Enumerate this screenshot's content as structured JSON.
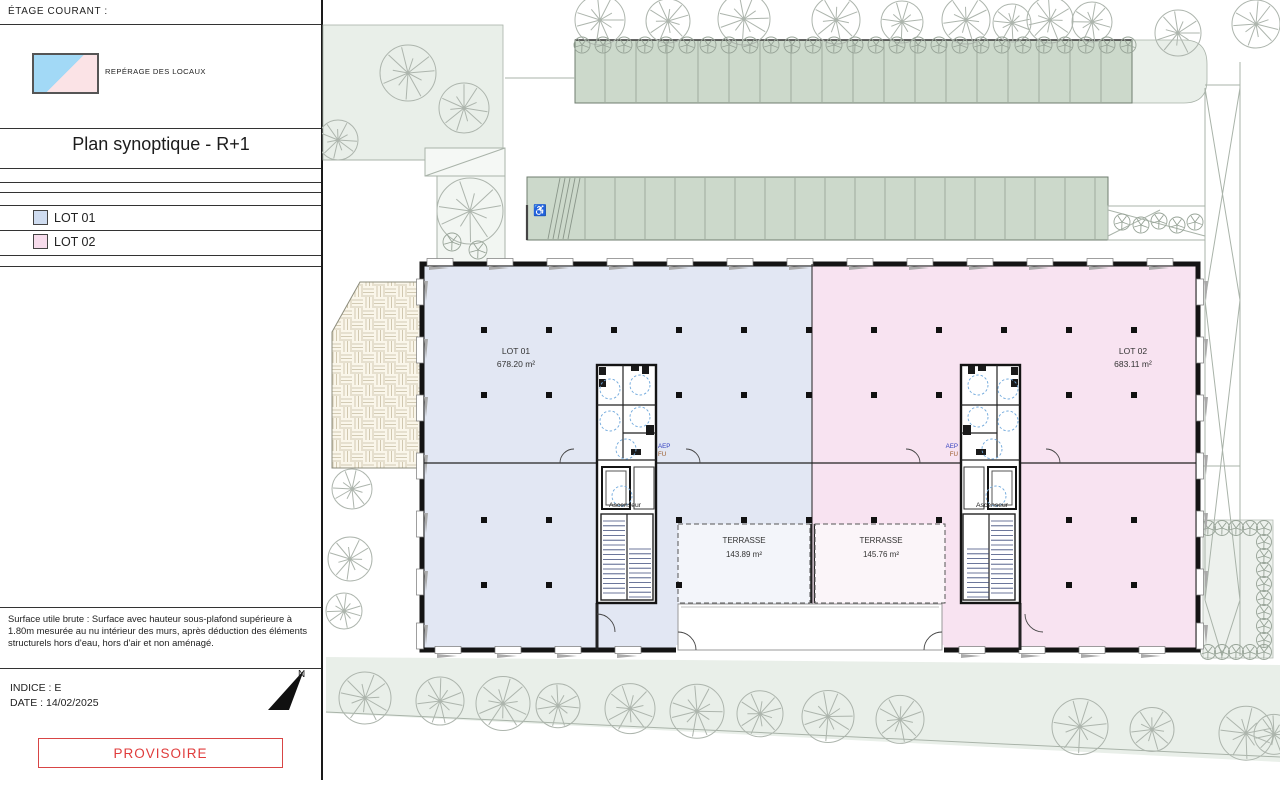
{
  "panel": {
    "etage_courant": "ÉTAGE COURANT :",
    "reperage": "REPÉRAGE DES LOCAUX",
    "title": "Plan synoptique - R+1",
    "lots": [
      {
        "label": "LOT 01"
      },
      {
        "label": "LOT 02"
      }
    ],
    "note": "Surface utile brute : Surface avec hauteur sous-plafond supérieure à 1.80m mesurée au nu intérieur des murs, après déduction des éléments structurels hors d'eau, hors d'air et non aménagé.",
    "indice": "INDICE : E",
    "date": "DATE : 14/02/2025",
    "north": "N",
    "stamp": "PROVISOIRE"
  },
  "plan": {
    "lot01": {
      "label": "LOT 01",
      "area": "678.20 m²"
    },
    "lot02": {
      "label": "LOT 02",
      "area": "683.11 m²"
    },
    "terrace01": {
      "label": "TERRASSE",
      "area": "143.89 m²"
    },
    "terrace02": {
      "label": "TERRASSE",
      "area": "145.76 m²"
    },
    "elevator_label": "Ascenseur",
    "aep_label": "AEP",
    "fu_label": "FU",
    "accessible_icon": "♿"
  },
  "colors": {
    "lot01_fill": "#e2e7f3",
    "lot02_fill": "#f8e3f1",
    "lot01_swatch": "#cfdcf0",
    "lot02_swatch": "#f7dcec",
    "terrace01_fill": "#f3f5fa",
    "terrace02_fill": "#fbf5f9",
    "legend_blue": "#a2d9f6",
    "legend_pink": "#fbe3e6",
    "stamp_red": "#e03c3c",
    "site_green": "#e9efe9",
    "hedge_green": "#ccd9cb"
  }
}
